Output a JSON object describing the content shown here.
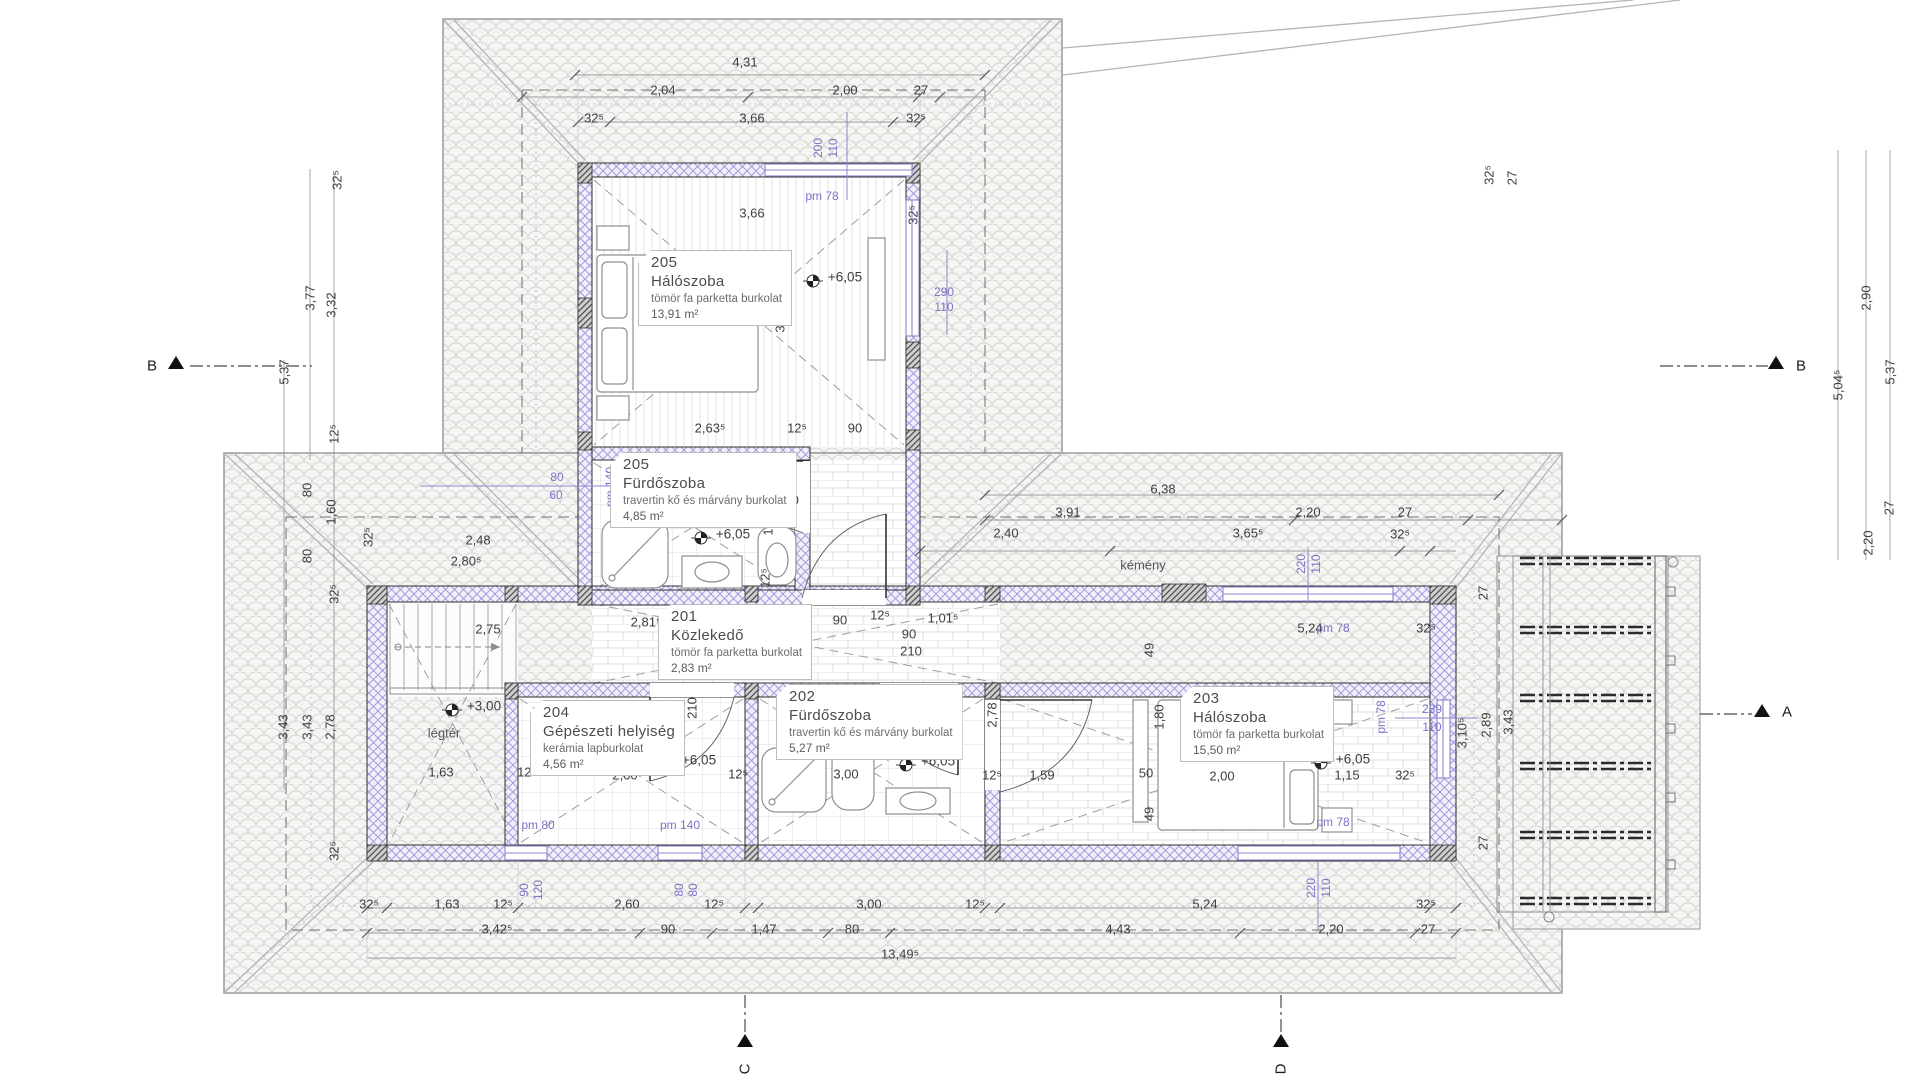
{
  "drawing": {
    "type_note": "emeleti alaprajz (floor plan)",
    "rooms": [
      {
        "num": "205",
        "name": "Hálószoba",
        "finish": "tömör fa parketta burkolat",
        "area": "13,91 m²",
        "x": 638,
        "y": 250
      },
      {
        "num": "205",
        "name": "Fürdőszoba",
        "finish": "travertin kő és márvány burkolat",
        "area": "4,85 m²",
        "x": 610,
        "y": 452
      },
      {
        "num": "201",
        "name": "Közlekedő",
        "finish": "tömör fa parketta burkolat",
        "area": "2,83 m²",
        "x": 658,
        "y": 604
      },
      {
        "num": "204",
        "name": "Gépészeti helyiség",
        "finish": "kerámia lapburkolat",
        "area": "4,56 m²",
        "x": 530,
        "y": 700
      },
      {
        "num": "202",
        "name": "Fürdőszoba",
        "finish": "travertin kő és márvány burkolat",
        "area": "5,27 m²",
        "x": 776,
        "y": 684
      },
      {
        "num": "203",
        "name": "Hálószoba",
        "finish": "tömör fa parketta burkolat",
        "area": "15,50 m²",
        "x": 1180,
        "y": 686
      }
    ],
    "dim_labels": [
      {
        "x": 745,
        "y": 62,
        "t": "4,31"
      },
      {
        "x": 663,
        "y": 90,
        "t": "2,04"
      },
      {
        "x": 845,
        "y": 90,
        "t": "2,00"
      },
      {
        "x": 921,
        "y": 90,
        "t": "27"
      },
      {
        "x": 594,
        "y": 118,
        "t": "32⁵"
      },
      {
        "x": 752,
        "y": 118,
        "t": "3,66"
      },
      {
        "x": 916,
        "y": 118,
        "t": "32⁵"
      },
      {
        "x": 752,
        "y": 213,
        "t": "3,66"
      },
      {
        "x": 913,
        "y": 215,
        "t": "32⁵",
        "r": -90
      },
      {
        "x": 780,
        "y": 320,
        "t": "3,32",
        "r": -90
      },
      {
        "x": 710,
        "y": 428,
        "t": "2,63⁵"
      },
      {
        "x": 797,
        "y": 428,
        "t": "12⁵"
      },
      {
        "x": 855,
        "y": 428,
        "t": "90"
      },
      {
        "x": 770,
        "y": 466,
        "t": "12⁵",
        "r": -90
      },
      {
        "x": 788,
        "y": 483,
        "t": "75"
      },
      {
        "x": 788,
        "y": 500,
        "t": "210"
      },
      {
        "x": 768,
        "y": 523,
        "t": "1,80",
        "r": -90
      },
      {
        "x": 765,
        "y": 578,
        "t": "12⁵",
        "r": -90
      },
      {
        "x": 337,
        "y": 180,
        "t": "32⁵",
        "r": -90
      },
      {
        "x": 310,
        "y": 298,
        "t": "3,77",
        "r": -90
      },
      {
        "x": 331,
        "y": 305,
        "t": "3,32",
        "r": -90
      },
      {
        "x": 284,
        "y": 372,
        "t": "5,37",
        "r": -90
      },
      {
        "x": 334,
        "y": 434,
        "t": "12⁵",
        "r": -90
      },
      {
        "x": 307,
        "y": 490,
        "t": "80",
        "r": -90
      },
      {
        "x": 331,
        "y": 512,
        "t": "1,60",
        "r": -90
      },
      {
        "x": 307,
        "y": 556,
        "t": "80",
        "r": -90
      },
      {
        "x": 368,
        "y": 537,
        "t": "32⁵",
        "r": -90
      },
      {
        "x": 478,
        "y": 540,
        "t": "2,48"
      },
      {
        "x": 466,
        "y": 561,
        "t": "2,80⁵"
      },
      {
        "x": 334,
        "y": 594,
        "t": "32⁵",
        "r": -90
      },
      {
        "x": 488,
        "y": 629,
        "t": "2,75"
      },
      {
        "x": 283,
        "y": 727,
        "t": "3,43",
        "r": -90
      },
      {
        "x": 307,
        "y": 727,
        "t": "3,43",
        "r": -90
      },
      {
        "x": 330,
        "y": 727,
        "t": "2,78",
        "r": -90
      },
      {
        "x": 334,
        "y": 851,
        "t": "32⁵",
        "r": -90
      },
      {
        "x": 646,
        "y": 622,
        "t": "2,81⁵"
      },
      {
        "x": 762,
        "y": 644,
        "t": "90",
        "r": -90
      },
      {
        "x": 840,
        "y": 620,
        "t": "90"
      },
      {
        "x": 880,
        "y": 615,
        "t": "12⁵"
      },
      {
        "x": 943,
        "y": 618,
        "t": "1,01⁵"
      },
      {
        "x": 909,
        "y": 634,
        "t": "90"
      },
      {
        "x": 911,
        "y": 651,
        "t": "210"
      },
      {
        "x": 675,
        "y": 710,
        "t": "90",
        "r": -90
      },
      {
        "x": 692,
        "y": 708,
        "t": "210",
        "r": -90
      },
      {
        "x": 918,
        "y": 710,
        "t": "75",
        "r": -90
      },
      {
        "x": 941,
        "y": 707,
        "t": "210",
        "r": -90
      },
      {
        "x": 441,
        "y": 772,
        "t": "1,63"
      },
      {
        "x": 527,
        "y": 772,
        "t": "12⁵"
      },
      {
        "x": 625,
        "y": 775,
        "t": "2,60"
      },
      {
        "x": 738,
        "y": 774,
        "t": "12⁵"
      },
      {
        "x": 846,
        "y": 774,
        "t": "3,00"
      },
      {
        "x": 992,
        "y": 715,
        "t": "2,78",
        "r": -90
      },
      {
        "x": 992,
        "y": 775,
        "t": "12⁵"
      },
      {
        "x": 1042,
        "y": 775,
        "t": "1,59"
      },
      {
        "x": 1149,
        "y": 650,
        "t": "49",
        "r": -90
      },
      {
        "x": 1146,
        "y": 773,
        "t": "50"
      },
      {
        "x": 1149,
        "y": 814,
        "t": "49",
        "r": -90
      },
      {
        "x": 1159,
        "y": 717,
        "t": "1,80",
        "r": -90
      },
      {
        "x": 1222,
        "y": 776,
        "t": "2,00"
      },
      {
        "x": 1347,
        "y": 775,
        "t": "1,15"
      },
      {
        "x": 1405,
        "y": 775,
        "t": "32⁵"
      },
      {
        "x": 1163,
        "y": 489,
        "t": "6,38"
      },
      {
        "x": 1068,
        "y": 512,
        "t": "3,91"
      },
      {
        "x": 1308,
        "y": 512,
        "t": "2,20"
      },
      {
        "x": 1405,
        "y": 512,
        "t": "27"
      },
      {
        "x": 1006,
        "y": 533,
        "t": "2,40"
      },
      {
        "x": 1248,
        "y": 533,
        "t": "3,65⁵"
      },
      {
        "x": 1400,
        "y": 534,
        "t": "32⁵"
      },
      {
        "x": 1310,
        "y": 628,
        "t": "5,24"
      },
      {
        "x": 1426,
        "y": 628,
        "t": "32⁵"
      },
      {
        "x": 1489,
        "y": 175,
        "t": "32⁵",
        "r": -90
      },
      {
        "x": 1512,
        "y": 178,
        "t": "27",
        "r": -90
      },
      {
        "x": 1866,
        "y": 298,
        "t": "2,90",
        "r": -90
      },
      {
        "x": 1838,
        "y": 385,
        "t": "5,04⁵",
        "r": -90
      },
      {
        "x": 1890,
        "y": 372,
        "t": "5,37",
        "r": -90
      },
      {
        "x": 1889,
        "y": 508,
        "t": "27",
        "r": -90
      },
      {
        "x": 1868,
        "y": 543,
        "t": "2,20",
        "r": -90
      },
      {
        "x": 1483,
        "y": 593,
        "t": "27",
        "r": -90
      },
      {
        "x": 1462,
        "y": 733,
        "t": "3,10⁵",
        "r": -90
      },
      {
        "x": 1486,
        "y": 725,
        "t": "2,89",
        "r": -90
      },
      {
        "x": 1508,
        "y": 722,
        "t": "3,43",
        "r": -90
      },
      {
        "x": 1483,
        "y": 843,
        "t": "27",
        "r": -90
      },
      {
        "x": 369,
        "y": 904,
        "t": "32⁵"
      },
      {
        "x": 447,
        "y": 904,
        "t": "1,63"
      },
      {
        "x": 503,
        "y": 904,
        "t": "12⁵"
      },
      {
        "x": 627,
        "y": 904,
        "t": "2,60"
      },
      {
        "x": 714,
        "y": 904,
        "t": "12⁵"
      },
      {
        "x": 869,
        "y": 904,
        "t": "3,00"
      },
      {
        "x": 975,
        "y": 904,
        "t": "12⁵"
      },
      {
        "x": 1205,
        "y": 904,
        "t": "5,24"
      },
      {
        "x": 1426,
        "y": 904,
        "t": "32⁵"
      },
      {
        "x": 497,
        "y": 929,
        "t": "3,42⁵"
      },
      {
        "x": 668,
        "y": 929,
        "t": "90"
      },
      {
        "x": 764,
        "y": 929,
        "t": "1,47"
      },
      {
        "x": 852,
        "y": 929,
        "t": "80"
      },
      {
        "x": 1118,
        "y": 929,
        "t": "4,43"
      },
      {
        "x": 1331,
        "y": 929,
        "t": "2,20"
      },
      {
        "x": 1428,
        "y": 929,
        "t": "27"
      },
      {
        "x": 900,
        "y": 954,
        "t": "13,49⁵"
      }
    ],
    "blue_labels": [
      {
        "x": 818,
        "y": 148,
        "t": "200",
        "r": -90
      },
      {
        "x": 833,
        "y": 148,
        "t": "110",
        "r": -90
      },
      {
        "x": 822,
        "y": 196,
        "t": "pm 78"
      },
      {
        "x": 944,
        "y": 292,
        "t": "290"
      },
      {
        "x": 944,
        "y": 307,
        "t": "110"
      },
      {
        "x": 557,
        "y": 477,
        "t": "80"
      },
      {
        "x": 556,
        "y": 495,
        "t": "60"
      },
      {
        "x": 610,
        "y": 487,
        "t": "pm 140",
        "r": -90
      },
      {
        "x": 538,
        "y": 825,
        "t": "pm 80"
      },
      {
        "x": 680,
        "y": 825,
        "t": "pm 140"
      },
      {
        "x": 524,
        "y": 890,
        "t": "90",
        "r": -90
      },
      {
        "x": 538,
        "y": 890,
        "t": "120",
        "r": -90
      },
      {
        "x": 679,
        "y": 890,
        "t": "80",
        "r": -90
      },
      {
        "x": 693,
        "y": 890,
        "t": "80",
        "r": -90
      },
      {
        "x": 1301,
        "y": 564,
        "t": "220",
        "r": -90
      },
      {
        "x": 1316,
        "y": 564,
        "t": "110",
        "r": -90
      },
      {
        "x": 1333,
        "y": 628,
        "t": "pm 78"
      },
      {
        "x": 1333,
        "y": 822,
        "t": "pm 78"
      },
      {
        "x": 1311,
        "y": 888,
        "t": "220",
        "r": -90
      },
      {
        "x": 1326,
        "y": 888,
        "t": "110",
        "r": -90
      },
      {
        "x": 1381,
        "y": 717,
        "t": "pm 78",
        "r": -90
      },
      {
        "x": 1432,
        "y": 709,
        "t": "289"
      },
      {
        "x": 1432,
        "y": 727,
        "t": "110"
      }
    ],
    "level_labels": [
      {
        "x": 845,
        "y": 277,
        "t": "+6,05"
      },
      {
        "x": 733,
        "y": 534,
        "t": "+6,05"
      },
      {
        "x": 484,
        "y": 706,
        "t": "+3,00"
      },
      {
        "x": 699,
        "y": 760,
        "t": "+6,05"
      },
      {
        "x": 938,
        "y": 761,
        "t": "+6,05"
      },
      {
        "x": 1353,
        "y": 759,
        "t": "+6,05"
      }
    ],
    "note_labels": [
      {
        "x": 444,
        "y": 733,
        "t": "légtér"
      },
      {
        "x": 1143,
        "y": 565,
        "t": "kémény"
      }
    ],
    "section_labels": [
      {
        "x": 152,
        "y": 366,
        "t": "B"
      },
      {
        "x": 1801,
        "y": 366,
        "t": "B"
      },
      {
        "x": 1787,
        "y": 712,
        "t": "A"
      },
      {
        "x": 745,
        "y": 1069,
        "t": "C",
        "r": -90
      },
      {
        "x": 1281,
        "y": 1069,
        "t": "D",
        "r": -90
      }
    ]
  }
}
